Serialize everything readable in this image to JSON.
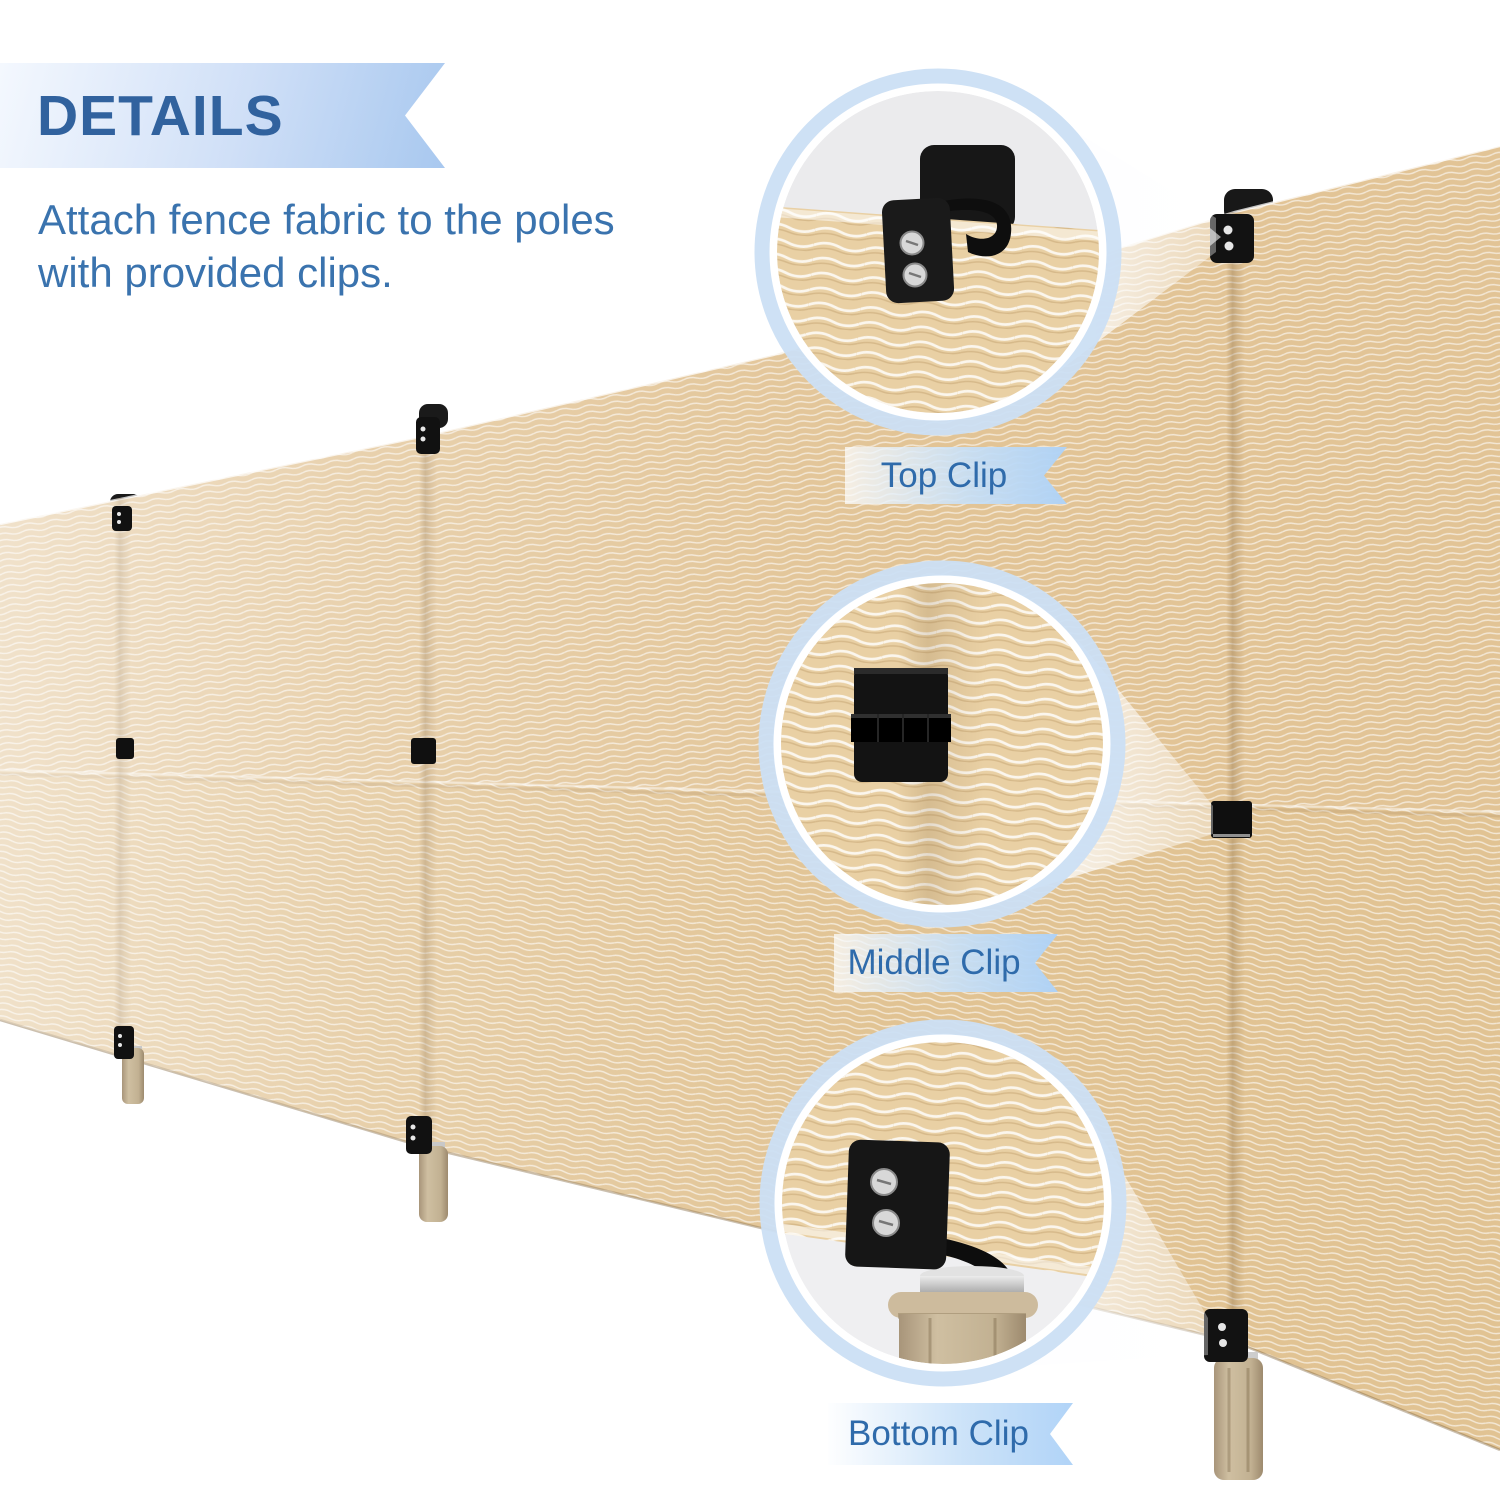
{
  "header": {
    "badge": "DETAILS",
    "description": "Attach fence fabric to the poles\nwith provided clips."
  },
  "callouts": [
    {
      "id": "top-clip",
      "label": "Top Clip"
    },
    {
      "id": "middle-clip",
      "label": "Middle Clip"
    },
    {
      "id": "bottom-clip",
      "label": "Bottom Clip"
    }
  ],
  "colors": {
    "banner_text": "#31629e",
    "body_text": "#3a73ae",
    "ribbon_text": "#2f6bab",
    "ribbon_blue": "#aed2f7",
    "banner_blue": "#a8c8ef",
    "callout_ring_blue": "#cbdff4",
    "fabric_tan": "#e2c496",
    "fabric_tan_zoom": "#e9d0a4",
    "pole_tan": "#c3b193",
    "clip_black": "#141414",
    "metal_silver": "#cccccc",
    "background": "#ffffff"
  }
}
